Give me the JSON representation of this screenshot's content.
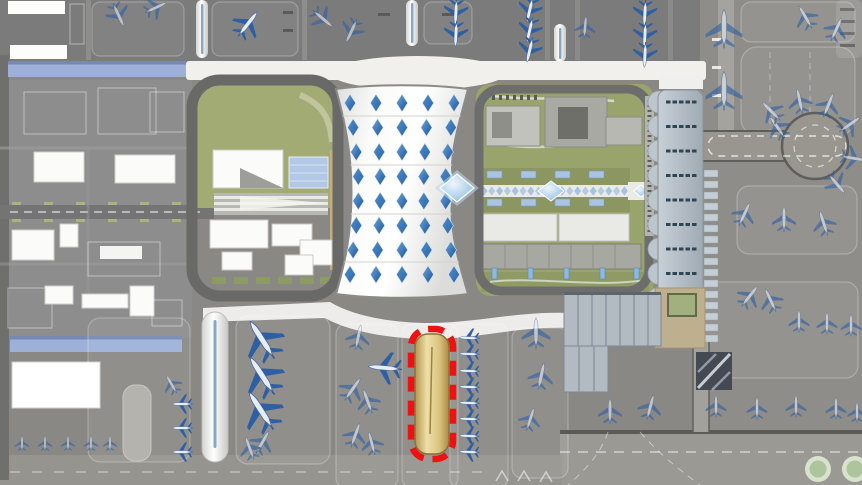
{
  "scene": {
    "type": "airport-master-plan-rendering",
    "canvas": {
      "w": 862,
      "h": 485
    },
    "palette": {
      "c_base": "#8a8885",
      "c_apron_dark": "#7b7b7b",
      "c_apron_mid": "#8f8d89",
      "c_apron_light": "#9b9994",
      "c_landside": "#8d8d8d",
      "c_road_dark": "#696967",
      "c_road_white": "#f1f0ed",
      "c_lawn": "#a3ab74",
      "c_gtc_green": "#99a46c",
      "c_olive": "#8b9660",
      "c_canopy_blue": "#9db1d8",
      "c_glass_blue": "#b3c8e6",
      "c_terminal_white": "#f4f4f2",
      "c_concourse": "#b6bfc7",
      "c_bay_dash": "#2e4654",
      "c_highlight_red": "#ee1212",
      "c_tan_dark": "#b3964e",
      "c_tan_light": "#eedfa8",
      "c_tree_ring": "#d7e3cc",
      "c_tree_fill": "#aec49c",
      "c_plane_wing": "#2e5fa3",
      "c_plane_body": "#e6edf6",
      "c_plane_outline": "#ffffff",
      "c_skylight_dark": "#1d4f9c",
      "c_skylight_light": "#5fa0d4"
    },
    "highlight": {
      "name": "highlighted-stand-pier",
      "x": 411,
      "y": 329,
      "w": 42,
      "h": 130,
      "border_color": "#ee1212",
      "fill_dark": "#b3964e",
      "fill_light": "#eedfa8"
    },
    "terminal": {
      "skylight_rows": 8,
      "skylight_cols": 5,
      "center_x": 402,
      "row_start": 103,
      "row_step": 24.5,
      "col_offsets": [
        -52,
        -26,
        0,
        26,
        52
      ],
      "row_spread": [
        1,
        0.94,
        0.88,
        0.84,
        0.84,
        0.88,
        0.94,
        1
      ],
      "skylight_hw": 5.6,
      "skylight_hh": 8.8,
      "feature_diamond": {
        "x": 457,
        "y": 188,
        "hw": 17,
        "hh": 14
      }
    },
    "gtc_axis": {
      "small_diamonds": 19,
      "x_start": 484,
      "x_step": 7.8,
      "y": 191,
      "hw": 3.5,
      "hh": 4.6,
      "big_diamond": {
        "x": 551,
        "y": 191,
        "hw": 13,
        "hh": 10
      },
      "end_diamond": {
        "x": 641,
        "y": 191,
        "hw": 7.5,
        "hh": 6
      },
      "blue_rect_xs": [
        487,
        521,
        555,
        589
      ],
      "blue_rect_rows_y": [
        171,
        199
      ]
    },
    "concourse": {
      "bays": 9,
      "bay_start_y": 102,
      "bay_step": 24.5,
      "dashes_per_bay": 5,
      "stand_bars": 16,
      "stand_start_y": 170,
      "stand_step": 11
    },
    "gtc_parking_tick_xs": [
      492,
      528,
      564,
      600,
      634
    ],
    "planes": {
      "blue": [
        [
          247,
          25,
          38,
          36
        ],
        [
          456,
          11,
          183,
          30
        ],
        [
          456,
          33,
          183,
          30
        ],
        [
          530,
          9,
          193,
          30
        ],
        [
          530,
          29,
          193,
          30
        ],
        [
          530,
          49,
          193,
          30
        ],
        [
          645,
          12,
          183,
          30
        ],
        [
          645,
          34,
          183,
          30
        ],
        [
          645,
          54,
          183,
          30
        ],
        [
          263,
          341,
          -33,
          52
        ],
        [
          263,
          377,
          -33,
          52
        ],
        [
          262,
          412,
          -33,
          52
        ],
        [
          386,
          368,
          -85,
          40
        ],
        [
          470,
          338,
          -88,
          24
        ],
        [
          470,
          354,
          -88,
          24
        ],
        [
          470,
          371,
          -88,
          24
        ],
        [
          470,
          387,
          -88,
          24
        ],
        [
          470,
          403,
          -88,
          24
        ],
        [
          470,
          419,
          -88,
          24
        ],
        [
          470,
          436,
          -88,
          24
        ],
        [
          470,
          452,
          -88,
          24
        ],
        [
          183,
          404,
          -90,
          24
        ],
        [
          183,
          428,
          -90,
          24
        ],
        [
          183,
          452,
          -90,
          24
        ]
      ],
      "outline": [
        [
          118,
          14,
          155,
          30
        ],
        [
          155,
          8,
          65,
          28
        ],
        [
          322,
          18,
          130,
          30
        ],
        [
          352,
          30,
          205,
          30
        ],
        [
          585,
          28,
          5,
          26
        ],
        [
          724,
          30,
          0,
          46
        ],
        [
          724,
          92,
          0,
          46
        ],
        [
          806,
          18,
          -30,
          30
        ],
        [
          836,
          30,
          25,
          30
        ],
        [
          778,
          128,
          -35,
          30
        ],
        [
          772,
          112,
          -45,
          30
        ],
        [
          800,
          102,
          -12,
          30
        ],
        [
          828,
          106,
          22,
          30
        ],
        [
          849,
          125,
          55,
          30
        ],
        [
          852,
          158,
          100,
          30
        ],
        [
          836,
          183,
          140,
          30
        ],
        [
          744,
          215,
          25,
          30
        ],
        [
          784,
          220,
          0,
          30
        ],
        [
          824,
          224,
          -18,
          30
        ],
        [
          749,
          297,
          38,
          30
        ],
        [
          771,
          301,
          -25,
          30
        ],
        [
          799,
          322,
          0,
          26
        ],
        [
          827,
          324,
          0,
          26
        ],
        [
          851,
          326,
          0,
          26
        ],
        [
          610,
          412,
          0,
          30
        ],
        [
          650,
          408,
          15,
          30
        ],
        [
          716,
          407,
          0,
          26
        ],
        [
          757,
          409,
          0,
          26
        ],
        [
          796,
          407,
          0,
          26
        ],
        [
          836,
          409,
          0,
          26
        ],
        [
          857,
          413,
          0,
          24
        ],
        [
          358,
          338,
          12,
          30
        ],
        [
          352,
          390,
          35,
          32
        ],
        [
          368,
          402,
          -20,
          30
        ],
        [
          355,
          436,
          20,
          30
        ],
        [
          372,
          444,
          -15,
          28
        ],
        [
          536,
          334,
          0,
          36
        ],
        [
          541,
          377,
          12,
          32
        ],
        [
          530,
          420,
          18,
          28
        ],
        [
          172,
          385,
          -30,
          24
        ],
        [
          262,
          443,
          30,
          30
        ],
        [
          250,
          449,
          -20,
          28
        ],
        [
          22,
          444,
          0,
          18
        ],
        [
          45,
          444,
          0,
          18
        ],
        [
          68,
          444,
          0,
          18
        ],
        [
          91,
          444,
          0,
          18
        ],
        [
          110,
          444,
          0,
          18
        ]
      ]
    },
    "trees": [
      {
        "x": 818,
        "y": 469,
        "r_outer": 13,
        "r_inner": 8.5
      },
      {
        "x": 855,
        "y": 469,
        "r_outer": 13,
        "r_inner": 8.5
      }
    ],
    "chevrons": [
      [
        502,
        476
      ],
      [
        524,
        476
      ],
      [
        546,
        477
      ]
    ]
  }
}
